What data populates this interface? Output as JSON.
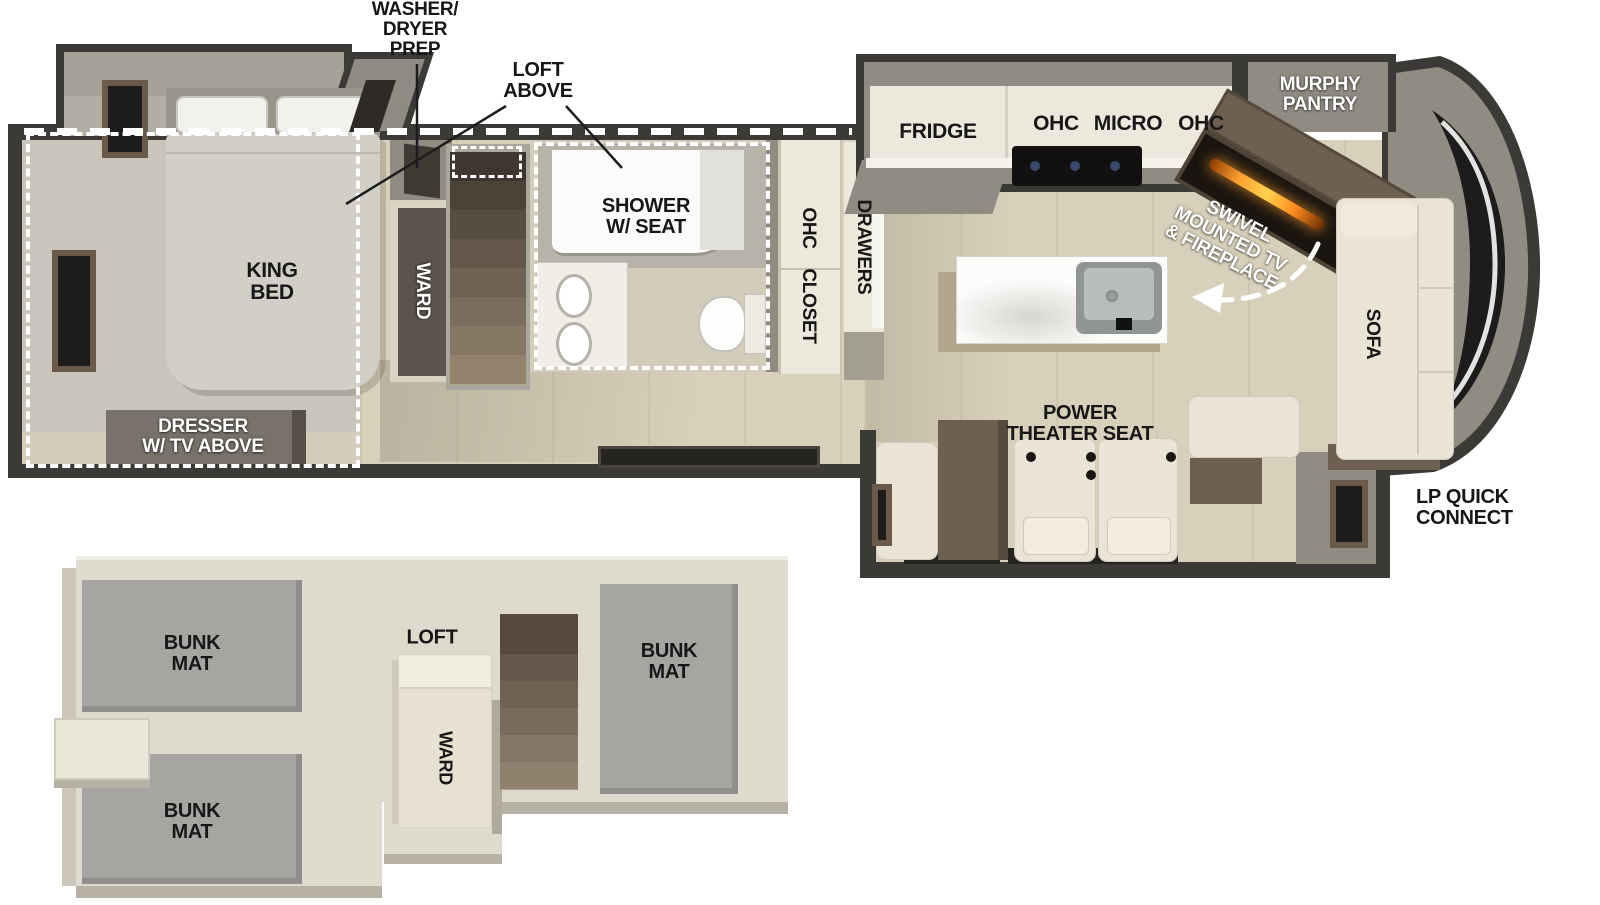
{
  "title": "Fifth-wheel RV floorplan with loft",
  "colors": {
    "wall_dark": "#3c3a37",
    "wall_gray": "#908c82",
    "slide_wall_gray": "#a5a196",
    "floor_wood": "#d9d0bb",
    "floor_bedroom_gray": "#c9c5ba",
    "cabinet_cream": "#ece8db",
    "counter_white": "#f4f2ea",
    "island_white": "#fcfcfb",
    "seat_ivory": "#e9e4d5",
    "furniture_brown": "#6e6051",
    "stair_brown_dark": "#3f372e",
    "stair_brown_light": "#93836d",
    "bunk_mat_gray": "#a6a5a1",
    "loft_floor": "#dedacd",
    "flame_orange": "#ff9d2e",
    "windshield_dark": "#1e1c1a",
    "label_black": "#171717",
    "label_white": "#ffffff",
    "leader_line": "#1d1d1d",
    "slide_dash_white": "#ffffff"
  },
  "main_floor": {
    "labels": {
      "washer_dryer_prep": [
        "WASHER/",
        "DRYER",
        "PREP"
      ],
      "loft_above": [
        "LOFT",
        "ABOVE"
      ],
      "king_bed": [
        "KING",
        "BED"
      ],
      "ward": "WARD",
      "shower": [
        "SHOWER",
        "W/ SEAT"
      ],
      "dresser": [
        "DRESSER",
        "W/ TV ABOVE"
      ],
      "ohc_closet_cab": [
        "OHC",
        "CLOSET"
      ],
      "drawers": "DRAWERS",
      "fridge": "FRIDGE",
      "ohc_left": "OHC",
      "micro": "MICRO",
      "ohc_right": "OHC",
      "murphy_pantry": [
        "MURPHY",
        "PANTRY"
      ],
      "swivel_tv": [
        "SWIVEL",
        "MOUNTED TV",
        "& FIREPLACE"
      ],
      "sofa": "SOFA",
      "power_theater_seat": [
        "POWER",
        "THEATER SEAT"
      ],
      "lp_quick_connect": [
        "LP QUICK",
        "CONNECT"
      ]
    }
  },
  "loft_floor": {
    "labels": {
      "bunk_mat_top": [
        "BUNK",
        "MAT"
      ],
      "bunk_mat_bottom": [
        "BUNK",
        "MAT"
      ],
      "bunk_mat_right": [
        "BUNK",
        "MAT"
      ],
      "loft": "LOFT",
      "ward": "WARD"
    }
  }
}
